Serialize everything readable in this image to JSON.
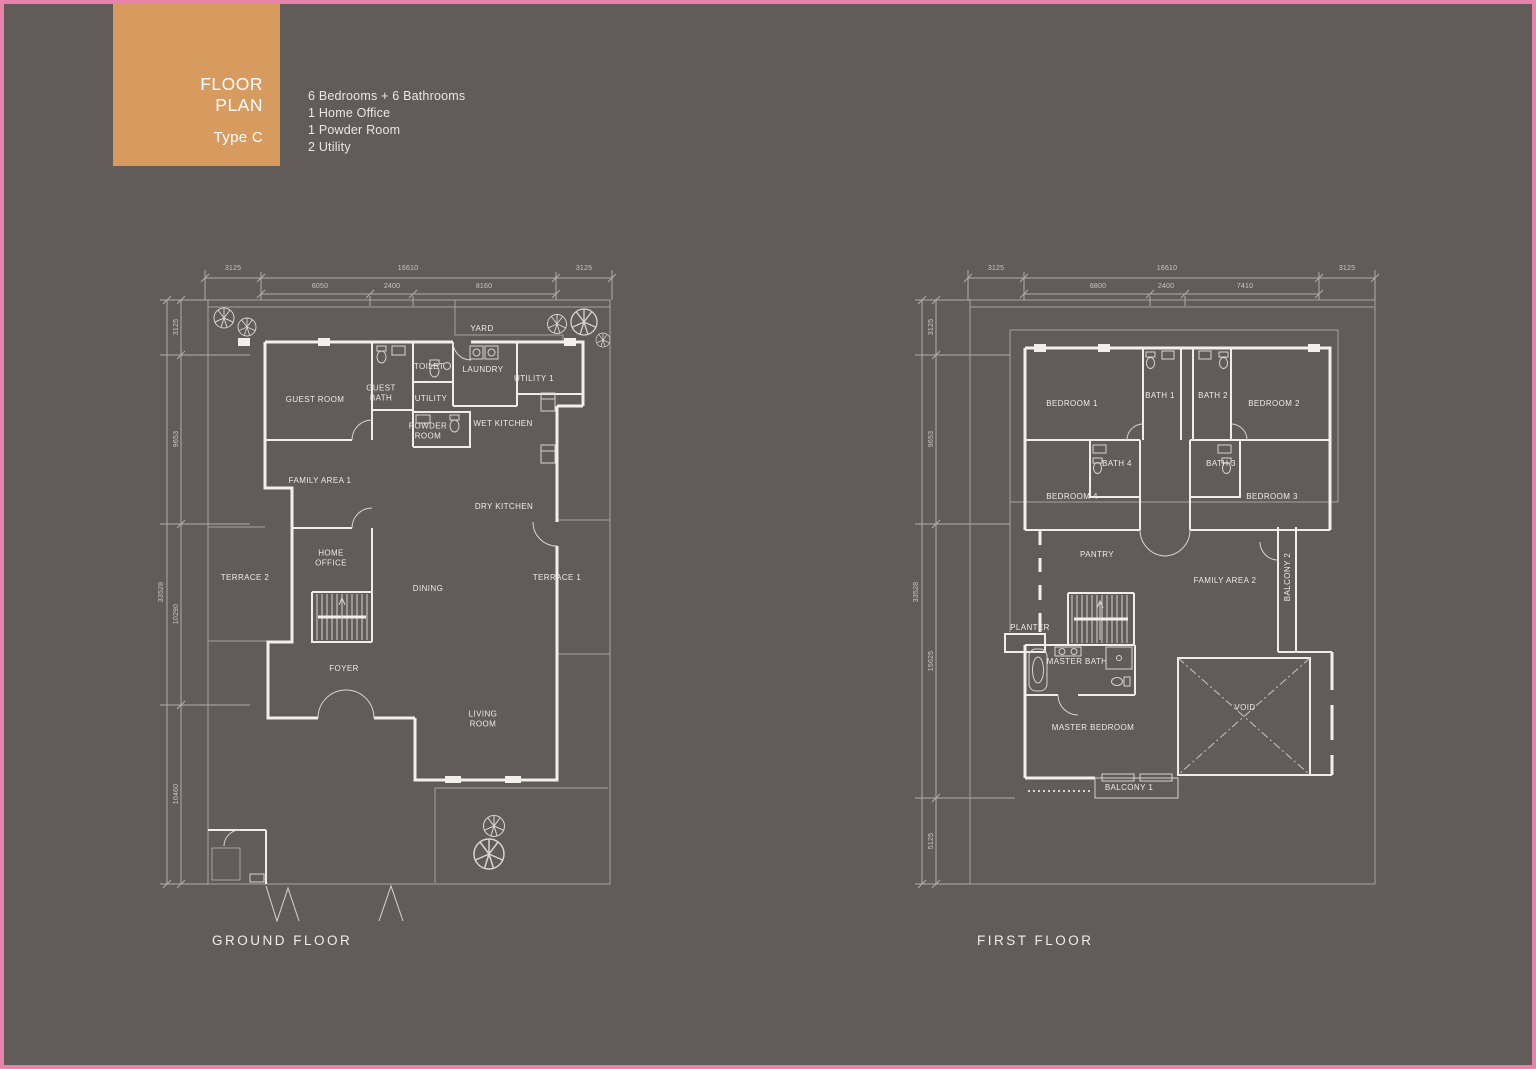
{
  "colors": {
    "background": "#615B59",
    "frame_border": "#E884AC",
    "badge_bg": "#D89B5F",
    "wall": "#F2EFEB",
    "thin_line": "#A8A2A0",
    "room_text": "#EDEAE6",
    "dim_text": "#CBC6C3"
  },
  "header": {
    "badge": {
      "line1": "FLOOR",
      "line2": "PLAN",
      "type": "Type C"
    },
    "features": [
      "6 Bedrooms + 6 Bathrooms",
      "1 Home Office",
      "1 Powder Room",
      "2 Utility"
    ]
  },
  "plans": [
    {
      "id": "ground-floor",
      "title": "GROUND  FLOOR",
      "title_pos": {
        "x": 212,
        "y": 941
      },
      "rooms": [
        {
          "label": "YARD",
          "x": 482,
          "y": 329
        },
        {
          "label": "GUEST ROOM",
          "x": 315,
          "y": 400
        },
        {
          "label": "GUEST\nBATH",
          "x": 381,
          "y": 393
        },
        {
          "label": "TOILET",
          "x": 429,
          "y": 367
        },
        {
          "label": "LAUNDRY",
          "x": 483,
          "y": 370
        },
        {
          "label": "UTILITY 1",
          "x": 534,
          "y": 379
        },
        {
          "label": "UTILITY",
          "x": 431,
          "y": 399
        },
        {
          "label": "POWDER\nROOM",
          "x": 428,
          "y": 431
        },
        {
          "label": "WET KITCHEN",
          "x": 503,
          "y": 424
        },
        {
          "label": "DRY KITCHEN",
          "x": 504,
          "y": 507
        },
        {
          "label": "FAMILY AREA 1",
          "x": 320,
          "y": 481
        },
        {
          "label": "HOME\nOFFICE",
          "x": 331,
          "y": 558
        },
        {
          "label": "TERRACE 2",
          "x": 245,
          "y": 578
        },
        {
          "label": "DINING",
          "x": 428,
          "y": 589
        },
        {
          "label": "TERRACE 1",
          "x": 557,
          "y": 578
        },
        {
          "label": "FOYER",
          "x": 344,
          "y": 669
        },
        {
          "label": "LIVING\nROOM",
          "x": 483,
          "y": 719
        }
      ],
      "dims_top": [
        {
          "label": "3125",
          "x": 233,
          "y": 269
        },
        {
          "label": "16610",
          "x": 408,
          "y": 269
        },
        {
          "label": "3125",
          "x": 584,
          "y": 269
        },
        {
          "label": "6050",
          "x": 320,
          "y": 287
        },
        {
          "label": "2400",
          "x": 392,
          "y": 287
        },
        {
          "label": "8160",
          "x": 484,
          "y": 287
        }
      ],
      "dims_left": [
        {
          "label": "33528",
          "x": 162,
          "y": 592
        },
        {
          "label": "3125",
          "x": 177,
          "y": 327
        },
        {
          "label": "9653",
          "x": 177,
          "y": 439
        },
        {
          "label": "10290",
          "x": 177,
          "y": 614
        },
        {
          "label": "10460",
          "x": 177,
          "y": 794
        }
      ]
    },
    {
      "id": "first-floor",
      "title": "FIRST  FLOOR",
      "title_pos": {
        "x": 977,
        "y": 941
      },
      "rooms": [
        {
          "label": "BEDROOM 1",
          "x": 1072,
          "y": 404
        },
        {
          "label": "BATH 1",
          "x": 1160,
          "y": 396
        },
        {
          "label": "BATH 2",
          "x": 1213,
          "y": 396
        },
        {
          "label": "BEDROOM 2",
          "x": 1274,
          "y": 404
        },
        {
          "label": "BATH 4",
          "x": 1117,
          "y": 464
        },
        {
          "label": "BATH 3",
          "x": 1221,
          "y": 464
        },
        {
          "label": "BEDROOM 4",
          "x": 1072,
          "y": 497
        },
        {
          "label": "BEDROOM 3",
          "x": 1272,
          "y": 497
        },
        {
          "label": "PANTRY",
          "x": 1097,
          "y": 555
        },
        {
          "label": "FAMILY AREA 2",
          "x": 1225,
          "y": 581
        },
        {
          "label": "BALCONY 2",
          "x": 1288,
          "y": 577,
          "rot": true
        },
        {
          "label": "PLANTER",
          "x": 1030,
          "y": 628
        },
        {
          "label": "MASTER BATH",
          "x": 1077,
          "y": 662
        },
        {
          "label": "MASTER BEDROOM",
          "x": 1093,
          "y": 728
        },
        {
          "label": "VOID",
          "x": 1245,
          "y": 708
        },
        {
          "label": "BALCONY 1",
          "x": 1129,
          "y": 788
        }
      ],
      "dims_top": [
        {
          "label": "3125",
          "x": 996,
          "y": 269
        },
        {
          "label": "16610",
          "x": 1167,
          "y": 269
        },
        {
          "label": "3125",
          "x": 1347,
          "y": 269
        },
        {
          "label": "6800",
          "x": 1098,
          "y": 287
        },
        {
          "label": "2400",
          "x": 1166,
          "y": 287
        },
        {
          "label": "7410",
          "x": 1245,
          "y": 287
        }
      ],
      "dims_left": [
        {
          "label": "33528",
          "x": 917,
          "y": 592
        },
        {
          "label": "3125",
          "x": 932,
          "y": 327
        },
        {
          "label": "9653",
          "x": 932,
          "y": 439
        },
        {
          "label": "15625",
          "x": 932,
          "y": 661
        },
        {
          "label": "5125",
          "x": 932,
          "y": 841
        }
      ]
    }
  ]
}
